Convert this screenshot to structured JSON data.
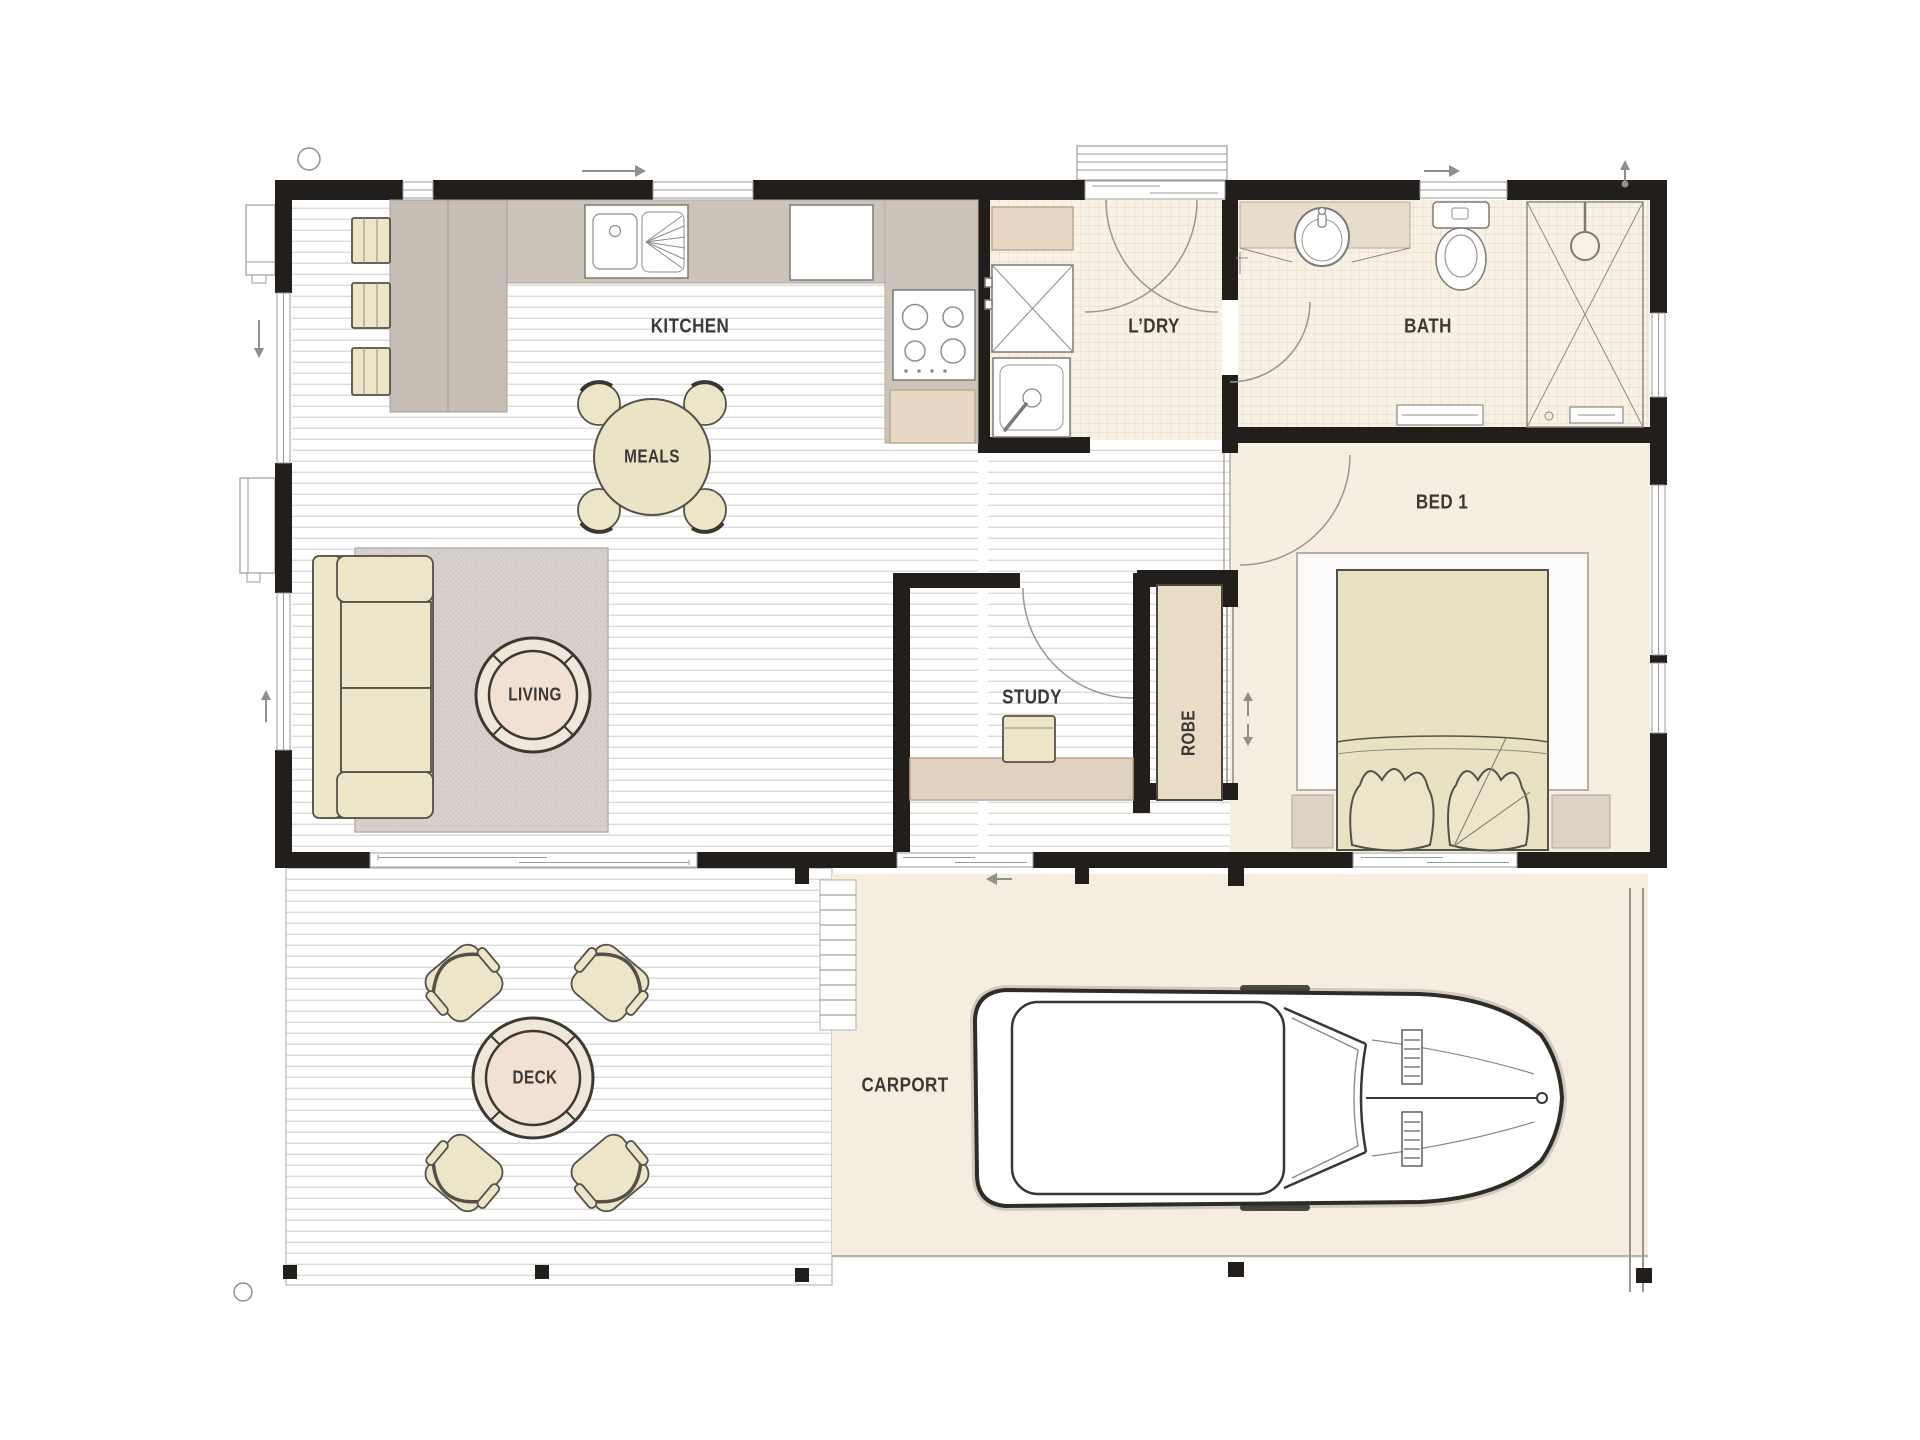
{
  "labels": {
    "kitchen": "KITCHEN",
    "meals": "MEALS",
    "laundry": "L’DRY",
    "bath": "BATH",
    "bed1": "BED 1",
    "study": "STUDY",
    "robe": "ROBE",
    "living": "LIVING",
    "deck": "DECK",
    "carport": "CARPORT"
  },
  "colors": {
    "wall": "#211e1b",
    "timber_line": "#dcdad6",
    "tile_bg": "#f8f2e6",
    "tile_line": "#e4d8c2",
    "cream_floor": "#f6efe1",
    "furniture_cream": "#ece5c7",
    "furniture_outline": "#55514a",
    "counter_gray": "#ccc4bb",
    "cabinet_beige": "#e7d7c4",
    "rug_gray": "#d8d1cb",
    "table_top": "#f2e0d2",
    "label_color": "#3b3835"
  },
  "furniture": [
    "kitchen-sink",
    "fridge",
    "cooktop",
    "bar-stools",
    "meals-table",
    "dining-chairs",
    "washing-machine",
    "laundry-tub",
    "laundry-bench",
    "vanity-basin",
    "toilet",
    "shower",
    "sofa",
    "coffee-table",
    "rug",
    "bed",
    "pillows",
    "nightstands",
    "robe-closet",
    "study-desk",
    "deck-table",
    "deck-armchairs",
    "car",
    "deck-stairs"
  ]
}
